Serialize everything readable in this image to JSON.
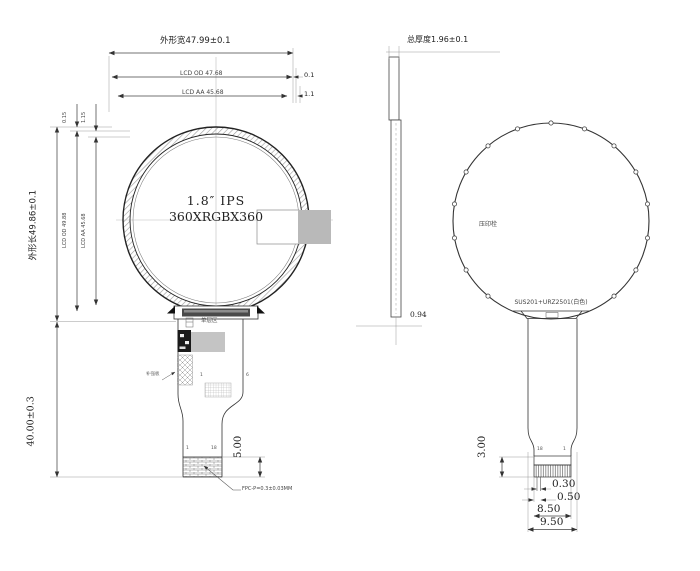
{
  "front_view": {
    "title_width": "外形宽47.99±0.1",
    "lcd_od_width": "LCD OD 47.68",
    "lcd_aa_width": "LCD AA 45.68",
    "od_gap_right": "0.1",
    "aa_gap_right": "1.1",
    "od_gap_top": "0.15",
    "aa_gap_top": "1.15",
    "title_height": "外形长49.86±0.1",
    "lcd_od_height": "LCD OD 49.88",
    "lcd_aa_height": "LCD AA 45.68",
    "fpc_length": "40.00±0.3",
    "display_size": "1.8″ IPS",
    "resolution": "360XRGBX360",
    "single_layer_label": "单层区",
    "stiffener_label": "补强板",
    "mesh_pin_first": "1",
    "mesh_pin_last": "6",
    "connector_pin_first": "1",
    "connector_pin_last": "18",
    "connector_height": "5.00",
    "fpc_pitch_note": "FPC-P=0.3±0.03MM"
  },
  "side_view": {
    "total_thickness": "总厚度1.96±0.1",
    "panel_thickness": "0.94"
  },
  "back_view": {
    "stamp_label": "压印栓",
    "material_label": "SUS201+URZ2501(白色)",
    "pin_last": "18",
    "pin_first": "1",
    "tail_dim": "3.00",
    "dim_030": "0.30",
    "dim_050": "0.50",
    "dim_850": "8.50",
    "dim_950": "9.50"
  }
}
